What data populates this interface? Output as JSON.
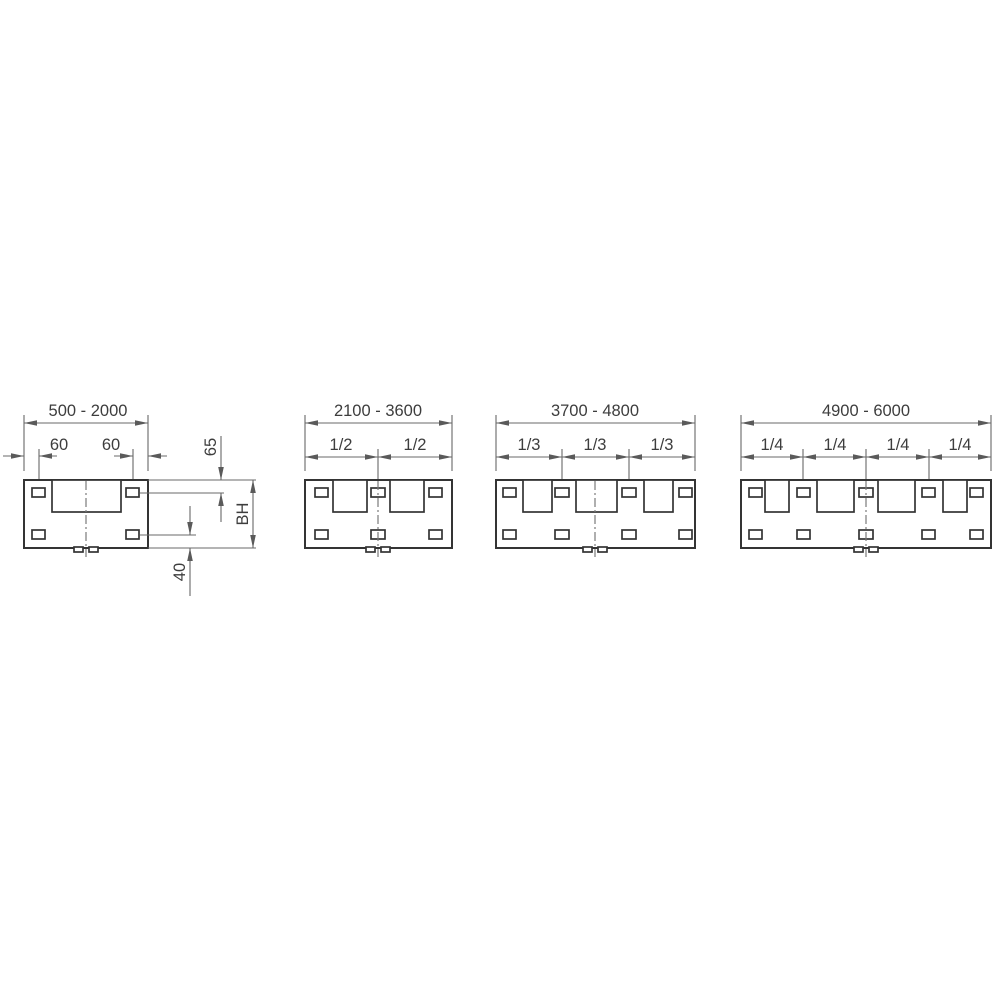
{
  "colors": {
    "background": "#ffffff",
    "outline": "#343434",
    "dimension_lines": "#696969",
    "text": "#3d3d3d"
  },
  "panels": [
    {
      "id": "panel-1",
      "range": "500 - 2000",
      "dims": {
        "left_offset": "60",
        "right_offset": "60",
        "top_slot_offset": "65",
        "build_height": "BH",
        "bottom_slot_offset": "40"
      }
    },
    {
      "id": "panel-2",
      "range": "2100 - 3600",
      "fractions": [
        "1/2",
        "1/2"
      ]
    },
    {
      "id": "panel-3",
      "range": "3700 - 4800",
      "fractions": [
        "1/3",
        "1/3",
        "1/3"
      ]
    },
    {
      "id": "panel-4",
      "range": "4900 - 6000",
      "fractions": [
        "1/4",
        "1/4",
        "1/4",
        "1/4"
      ]
    }
  ]
}
